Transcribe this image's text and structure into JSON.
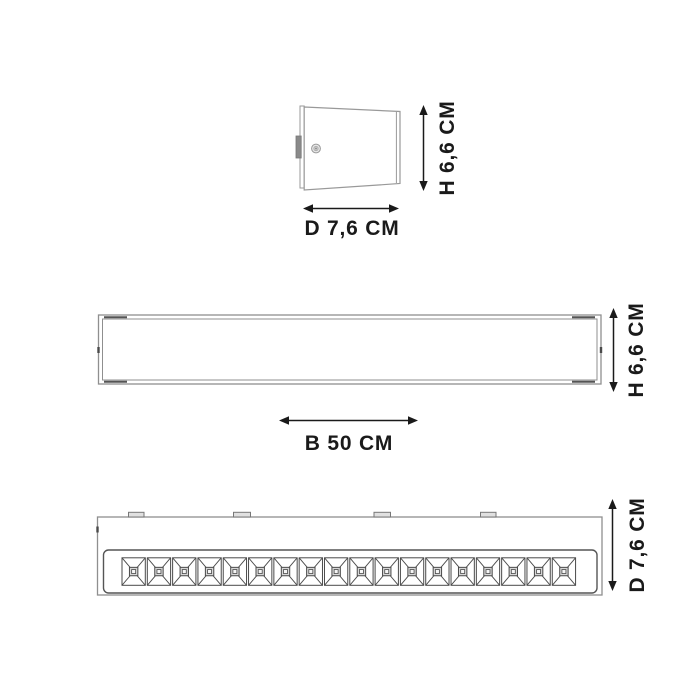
{
  "diagram": {
    "views": {
      "side": {
        "height_label": "H 6,6 CM",
        "depth_label": "D 7,6 CM"
      },
      "front": {
        "height_label": "H 6,6 CM",
        "width_label": "B 50 CM"
      },
      "bottom": {
        "depth_label": "D 7,6 CM",
        "louver_cell_count": 18,
        "mount_tab_count": 4
      }
    },
    "colors": {
      "background": "#ffffff",
      "figure_line": "#8f8f8f",
      "detail_line": "#4a4a4a",
      "dimension": "#1a1a1a"
    }
  }
}
